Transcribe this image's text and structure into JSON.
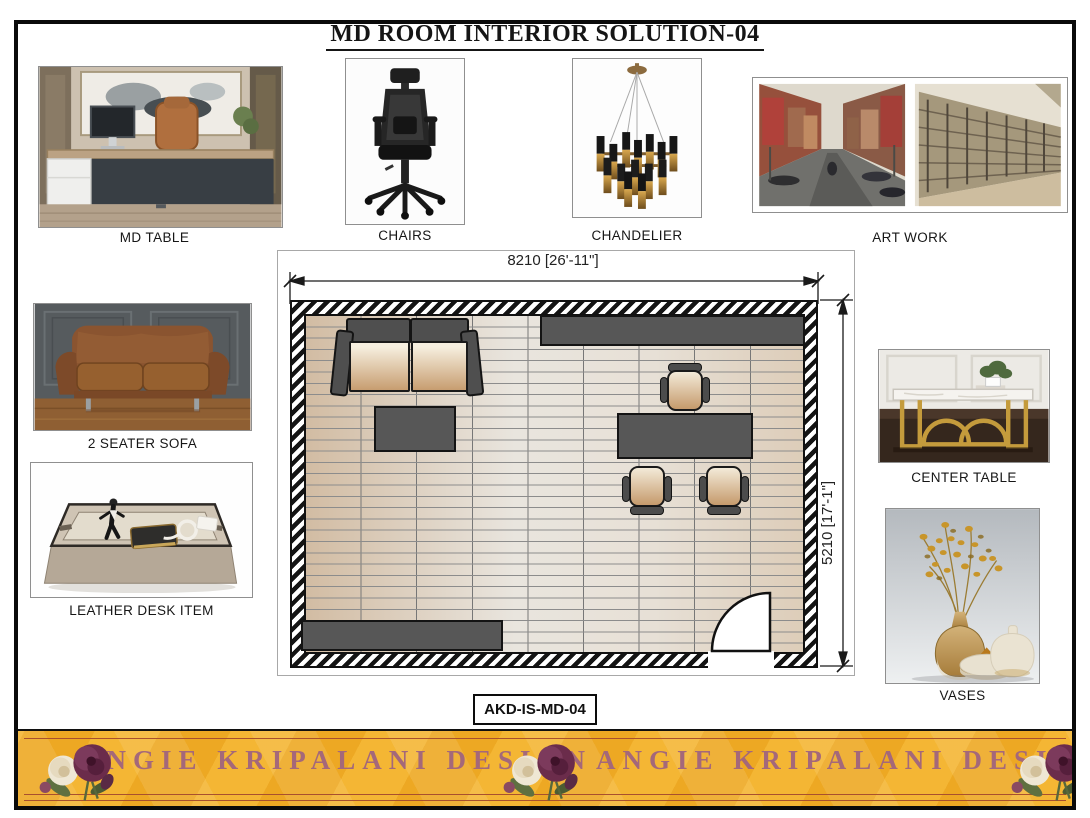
{
  "page": {
    "title": "MD ROOM INTERIOR SOLUTION-04",
    "code_tag": "AKD-IS-MD-04"
  },
  "products": {
    "md_table": {
      "label": "MD TABLE"
    },
    "chairs": {
      "label": "CHAIRS"
    },
    "chandelier": {
      "label": "CHANDELIER"
    },
    "art_work": {
      "label": "ART WORK"
    },
    "two_seater_sofa": {
      "label": "2 SEATER SOFA"
    },
    "leather_desk_item": {
      "label": "LEATHER DESK ITEM"
    },
    "center_table": {
      "label": "CENTER TABLE"
    },
    "vases": {
      "label": "VASES"
    }
  },
  "floor_plan": {
    "width_dimension": "8210 [26'-11\"]",
    "height_dimension": "5210 [17'-1\"]"
  },
  "banner": {
    "brand_left": "ANGIE KRIPALANI DESIGN",
    "brand_right": "ANGIE KRIPALANI DESIGN",
    "colors": {
      "gold": "#EDA823",
      "text_plum": "#A4687A",
      "rule_red": "#A8502E"
    }
  },
  "colors": {
    "wall_hatch_dark": "#141414",
    "plan_furniture_dark": "#575757",
    "plan_cushion_beige": "#E8D7BC",
    "floor_tile_tan": "#D2BCA3",
    "floor_tile_grey": "#E9E5DE"
  }
}
